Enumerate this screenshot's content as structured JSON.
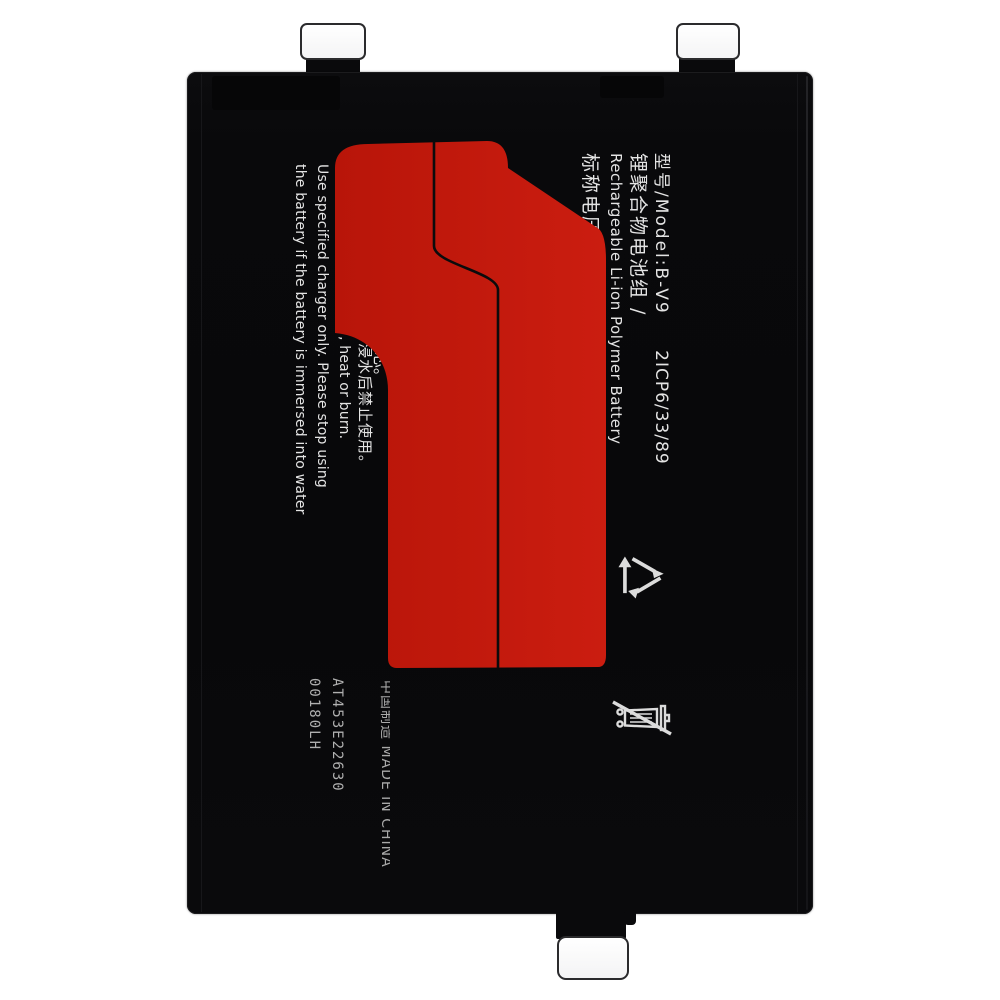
{
  "scene": {
    "background": "#ffffff",
    "subject": "smartphone replacement battery, top view, printed label rotated 90 degrees"
  },
  "battery": {
    "body_color": "#09090b",
    "pull_tab_color": "#ffffff",
    "graphic_color": "#c41a0f",
    "text_color": "#e4e4e4",
    "graphic": "large red numeral-1 style shape with thin black contour line"
  },
  "label": {
    "model_line": {
      "model": "型号/Model:B-V9",
      "cell_code": "2ICP6/33/89"
    },
    "type_cn": "锂聚合物电池组 /",
    "type_en": "Rechargeable Li-ion Polymer Battery",
    "voltage_partial": "标称电压",
    "warning_fragment_cn_1": "芯。",
    "warning_fragment_cn_2": "浸水后禁止使用。",
    "warning_fragment_en": ", heat or burn.",
    "warning_en_1": "Use specified charger only. Please stop using",
    "warning_en_2": "the battery if the battery is immersed into water",
    "origin": "中国制造 MADE IN CHINA",
    "serial_1": "AT453E22630",
    "serial_2": "00180LH",
    "icons": {
      "recycle": "recycle-icon",
      "no_disposal": "crossed-bin-icon"
    }
  }
}
